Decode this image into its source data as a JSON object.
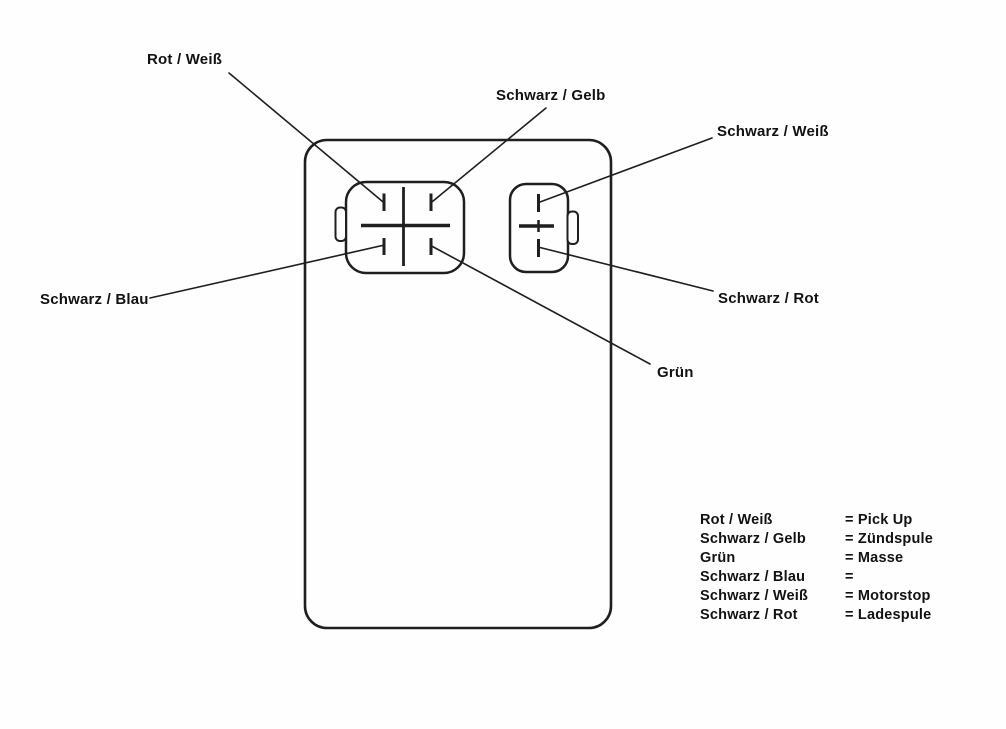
{
  "diagram": {
    "description": "CDI unit connector pinout diagram with German wire color callouts",
    "callouts": {
      "rot_weiss": "Rot / Weiß",
      "schwarz_gelb": "Schwarz / Gelb",
      "schwarz_weiss": "Schwarz / Weiß",
      "schwarz_blau": "Schwarz / Blau",
      "gruen": "Grün",
      "schwarz_rot": "Schwarz / Rot"
    },
    "legend": {
      "rows": [
        {
          "wire": "Rot / Weiß",
          "fn": "= Pick Up"
        },
        {
          "wire": "Schwarz / Gelb",
          "fn": "= Zündspule"
        },
        {
          "wire": "Grün",
          "fn": "= Masse"
        },
        {
          "wire": "Schwarz / Blau",
          "fn": "="
        },
        {
          "wire": "Schwarz / Weiß",
          "fn": "= Motorstop"
        },
        {
          "wire": "Schwarz / Rot",
          "fn": "= Ladespule"
        }
      ]
    },
    "colors": {
      "line": "#1f1f1f",
      "text": "#121212",
      "background": "#fefefe"
    }
  }
}
